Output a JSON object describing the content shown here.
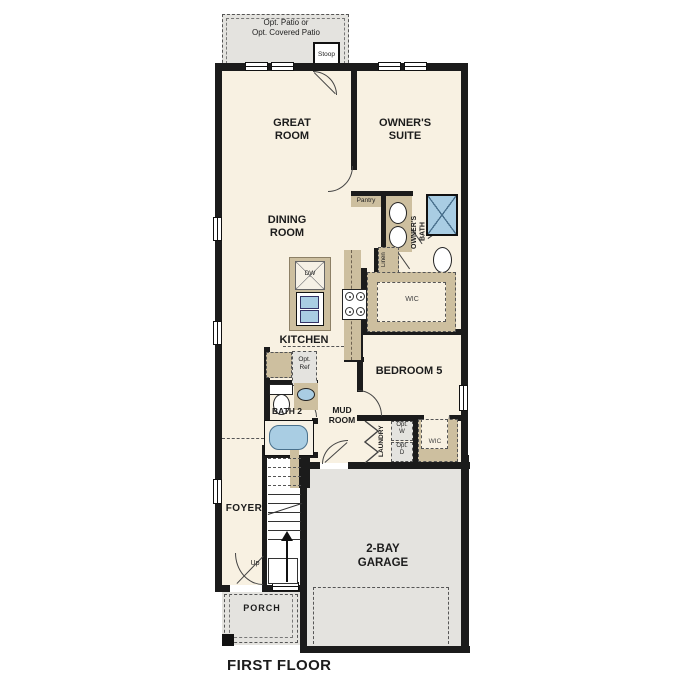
{
  "title": "FIRST FLOOR",
  "colors": {
    "wall": "#1b1b1b",
    "floor": "#f8f1e2",
    "outdoor": "#e4e3df",
    "cabinet": "#cdbf9f",
    "fixture": "#a9cde3"
  },
  "rooms": {
    "patio": "Opt. Patio or\nOpt. Covered Patio",
    "stoop": "Stoop",
    "great_room": "GREAT\nROOM",
    "owners_suite": "OWNER'S\nSUITE",
    "dining_room": "DINING\nROOM",
    "pantry": "Pantry",
    "owners_bath": "OWNER'S\nBATH",
    "linen": "Linen",
    "owners_wic": "WIC",
    "kitchen": "KITCHEN",
    "bedroom5": "BEDROOM 5",
    "bath2": "BATH 2",
    "mud_room": "MUD\nROOM",
    "laundry": "LAUNDRY",
    "bed5_wic": "WIC",
    "foyer": "FOYER",
    "garage": "2-BAY\nGARAGE",
    "porch": "PORCH"
  },
  "fixtures": {
    "dishwasher": "DW",
    "opt_ref": "Opt.\nRef",
    "opt_washer": "Opt.\nW",
    "opt_dryer": "Opt.\nD",
    "stairs_up": "Up"
  }
}
